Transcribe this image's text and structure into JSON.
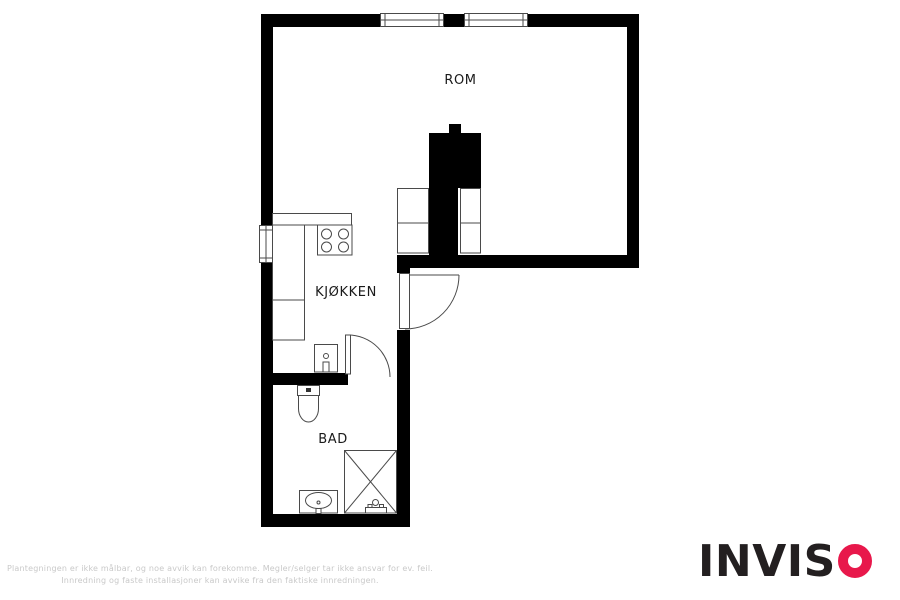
{
  "floorplan": {
    "room_labels": {
      "rom": "ROM",
      "kjokken": "KJØKKEN",
      "bad": "BAD"
    },
    "colors": {
      "wall": "#000000",
      "fixture_outline": "#4a4a4a",
      "label_text": "#1a1a1a"
    },
    "fixtures": [
      "top-window-left",
      "top-window-right",
      "kitchen-window",
      "chimney",
      "cabinet-left",
      "cabinet-right",
      "kitchen-counter",
      "stove",
      "kitchen-sink",
      "bathroom-door",
      "entry-door",
      "toilet",
      "bathroom-sink",
      "shower"
    ]
  },
  "footer": {
    "disclaimer": {
      "line1": "Plantegningen er ikke målbar, og noe avvik kan forekomme. Megler/selger tar ikke ansvar for ev. feil.",
      "line2": "Innredning og faste installasjoner kan avvike fra den faktiske innredningen.",
      "text_color": "#c9c9c9"
    },
    "logo": {
      "text": "INVIS",
      "o_letter": "O",
      "text_color": "#231f20",
      "o_color": "#e8184b"
    }
  }
}
